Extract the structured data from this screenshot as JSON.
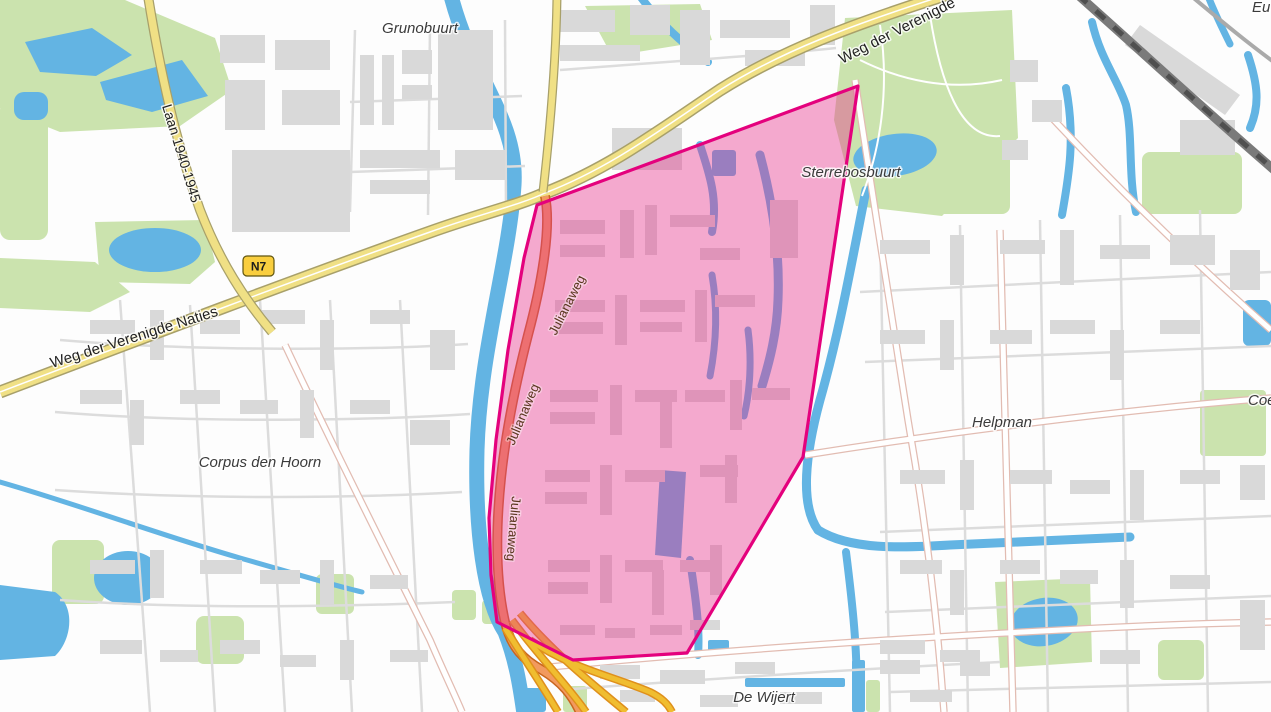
{
  "map": {
    "description": "Street map of south Groningen with a highlighted pink polygon over the Julianaweg / Rivierenbuurt area",
    "place_labels": {
      "grunobuurt": "Grunobuurt",
      "sterrebosbuurt": "Sterrebosbuurt",
      "corpus_den_hoorn": "Corpus den Hoorn",
      "helpman": "Helpman",
      "de_wijert": "De Wijert",
      "europapark_partial": "Eu",
      "coendersborg_partial": "Coen"
    },
    "road_labels": {
      "weg_der_verenigde_naties": "Weg der Verenigde Naties",
      "weg_der_verenigde_naties_partial": "Weg der Verenigde",
      "laan_1940_1945": "Laan 1940-1945",
      "julianaweg": "Julianaweg",
      "n7": "N7"
    },
    "overlay": {
      "name": "highlighted-area",
      "stroke_color": "#e4017d",
      "fill_color": "rgba(230,52,140,0.42)"
    },
    "colors": {
      "water": "#63b4e3",
      "park": "#cbe3ae",
      "building": "#d9d9d9",
      "road_motorway_yellow": "#f0e085",
      "road_trunk_orange": "#f29a5e",
      "road_ramp_gold": "#f0bd30",
      "railway": "#7a7a7a",
      "badge_fill": "#f9ce3f"
    }
  }
}
